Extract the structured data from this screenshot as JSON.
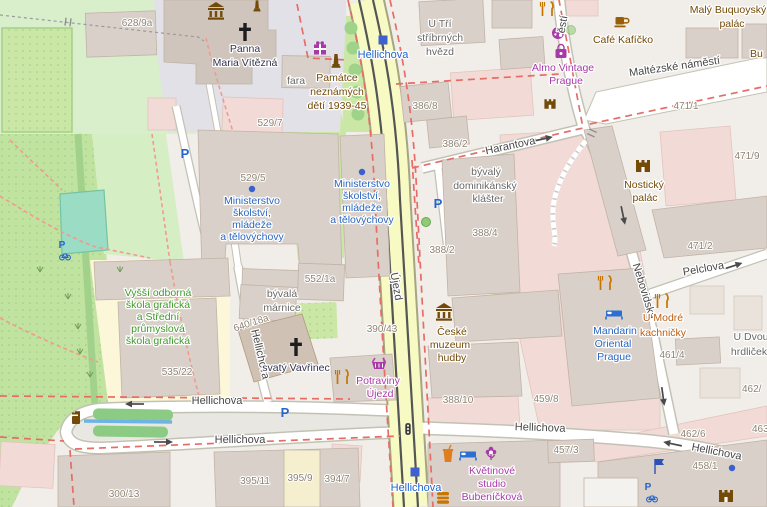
{
  "app": {
    "name": "openstreetmap-slippy-map-view",
    "city_area": "Malá Strana, Prague"
  },
  "colors": {
    "background": "#f1eee9",
    "road_secondary_yellow": "#f7fac2",
    "road_white": "#ffffff",
    "park_green": "#c0e3a0",
    "garden_green": "#cbe7a6",
    "building_fill": "#d9d0c9",
    "pink_area": "#f2dbd7",
    "pitch_teal": "#9adcc4",
    "school_yellow": "#fcf7d9",
    "pedestrian_gray": "#e2e1e8",
    "water_blue": "#6db3e3",
    "boundary_red": "#e66c66",
    "path_salmon": "#f19a8e",
    "poi_blue": "#2a65c0",
    "transport_blue": "#4160cf",
    "shop_purple": "#a839a8",
    "food_orange": "#c77400",
    "tourism_brown": "#734a08",
    "school_text_green": "#3f9a28"
  },
  "streets": {
    "ujezd": "Újezd",
    "hellichova": "Hellichova",
    "harantova": "Harantova",
    "maltezske_namesti": "Maltézské náměstí",
    "namesti_fragment": "ěstí",
    "pelclova": "Pelclova",
    "nebovidska": "Nebovidská"
  },
  "transport": {
    "tram_stop_name": "Hellichova"
  },
  "house_numbers": {
    "n628_9a": "628/9a",
    "n529_7": "529/7",
    "n529_5": "529/5",
    "n386_8": "386/8",
    "n386_2": "386/2",
    "n388_4": "388/4",
    "n388_2": "388/2",
    "n471_1": "471/1",
    "n471_9": "471/9",
    "n471_2": "471/2",
    "n552_1a": "552/1a",
    "n640_18a": "640/18a",
    "n390_43": "390/43",
    "n535_22": "535/22",
    "n388_10": "388/10",
    "n459_8": "459/8",
    "n461_4": "461/4",
    "n462_6": "462/6",
    "n463_part": "463/",
    "n462_part": "462/",
    "n300_13": "300/13",
    "n395_11": "395/11",
    "n395_9": "395/9",
    "n394_7": "394/7",
    "n457_3": "457/3",
    "n458_1": "458/1"
  },
  "pois": {
    "panna_maria": {
      "lines": [
        "Panna",
        "Maria Vítězná"
      ]
    },
    "fara": "fara",
    "memorial_children": {
      "lines": [
        "Památce",
        "neznámých",
        "dětí 1939-45"
      ]
    },
    "u_tri_hvezd": {
      "lines": [
        "U Tří",
        "stříbrných",
        "hvězd"
      ]
    },
    "almo": {
      "lines": [
        "Almo Vintage",
        "Prague"
      ]
    },
    "cafe_kaficko": "Café Kafíčko",
    "maly_buquoysky": {
      "lines": [
        "Malý Buquoyský",
        "palác"
      ]
    },
    "bu_partial": "Bu",
    "nosticky": {
      "lines": [
        "Nostický",
        "palác"
      ]
    },
    "klaster": {
      "lines": [
        "bývalý",
        "dominikánský",
        "klášter"
      ]
    },
    "ministerstvo": {
      "lines": [
        "Ministerstvo",
        "školství,",
        "mládeže",
        "a tělovýchovy"
      ]
    },
    "marnice": {
      "lines": [
        "bývalá",
        "márnice"
      ]
    },
    "vavrinec": "svatý Vavřinec",
    "potraviny": {
      "lines": [
        "Potraviny",
        "Újezd"
      ]
    },
    "muzeum": {
      "lines": [
        "České",
        "muzeum",
        "hudby"
      ]
    },
    "mandarin": {
      "lines": [
        "Mandarin",
        "Oriental",
        "Prague"
      ]
    },
    "kachnicky": {
      "lines": [
        "U Modré",
        "kachničky"
      ]
    },
    "hrdlicky": {
      "lines": [
        "U Dvou",
        "hrdliček"
      ]
    },
    "skola": {
      "lines": [
        "Vyšší odborná",
        "škola grafická",
        "a Střední",
        "průmyslová",
        "škola grafická"
      ]
    },
    "kvetinove": {
      "lines": [
        "Květinové",
        "studio",
        "Bubeníčková"
      ]
    }
  },
  "icons": {
    "parking_glyph": "P"
  }
}
